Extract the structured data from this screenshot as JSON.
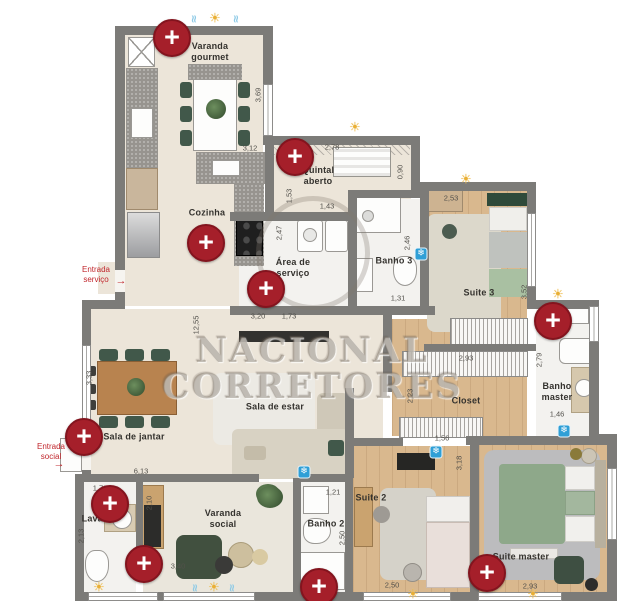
{
  "watermark": {
    "line1": "NACIONAL",
    "line2": "CORRETORES"
  },
  "glyphs": {
    "marker": "+",
    "sun": "☀",
    "snowflake": "❄",
    "water": "≈",
    "arrow": "→"
  },
  "colors": {
    "marker_red": "#a51f2a",
    "entrance_red": "#c1272d",
    "sun_yellow": "#e9af35",
    "snowflake_blue": "#2f9fd6",
    "wall_gray": "#7c7b78",
    "wood_floor": "#d9b88e"
  },
  "rooms": [
    {
      "id": "varanda-gourmet",
      "label": "Varanda\ngourmet",
      "x": 210,
      "y": 52
    },
    {
      "id": "quintal-aberto",
      "label": "Quintal\naberto",
      "x": 318,
      "y": 176
    },
    {
      "id": "cozinha",
      "label": "Cozinha",
      "x": 207,
      "y": 213
    },
    {
      "id": "area-de-servico",
      "label": "Área de\nserviço",
      "x": 293,
      "y": 268
    },
    {
      "id": "banho-3",
      "label": "Banho 3",
      "x": 394,
      "y": 261
    },
    {
      "id": "suite-3",
      "label": "Suite 3",
      "x": 479,
      "y": 293
    },
    {
      "id": "banho-master",
      "label": "Banho\nmaster",
      "x": 557,
      "y": 392
    },
    {
      "id": "closet",
      "label": "Closet",
      "x": 466,
      "y": 401
    },
    {
      "id": "sala-de-estar",
      "label": "Sala de estar",
      "x": 275,
      "y": 407
    },
    {
      "id": "sala-de-jantar",
      "label": "Sala de jantar",
      "x": 134,
      "y": 437
    },
    {
      "id": "lavabo",
      "label": "Lavabo",
      "x": 98,
      "y": 519
    },
    {
      "id": "varanda-social",
      "label": "Varanda\nsocial",
      "x": 223,
      "y": 519
    },
    {
      "id": "banho-2",
      "label": "Banho 2",
      "x": 326,
      "y": 524
    },
    {
      "id": "suite-2",
      "label": "Suite 2",
      "x": 371,
      "y": 498
    },
    {
      "id": "suite-master",
      "label": "Suite master",
      "x": 521,
      "y": 557
    }
  ],
  "entrances": [
    {
      "id": "entrada-servico",
      "label": "Entrada\nserviço",
      "x": 96,
      "y": 275,
      "ax": 121,
      "ay": 281
    },
    {
      "id": "entrada-social",
      "label": "Entrada\nsocial",
      "x": 51,
      "y": 452,
      "ax": 59,
      "ay": 464
    }
  ],
  "dimensions": [
    {
      "t": "3,69",
      "x": 258,
      "y": 95,
      "v": 1
    },
    {
      "t": "3,12",
      "x": 250,
      "y": 148,
      "v": 0
    },
    {
      "t": "2,78",
      "x": 332,
      "y": 147,
      "v": 0
    },
    {
      "t": "0,90",
      "x": 400,
      "y": 172,
      "v": 1
    },
    {
      "t": "1,53",
      "x": 289,
      "y": 196,
      "v": 1
    },
    {
      "t": "1,43",
      "x": 327,
      "y": 206,
      "v": 0
    },
    {
      "t": "2,53",
      "x": 451,
      "y": 198,
      "v": 0
    },
    {
      "t": "3,52",
      "x": 524,
      "y": 292,
      "v": 1
    },
    {
      "t": "2,46",
      "x": 407,
      "y": 243,
      "v": 1
    },
    {
      "t": "1,31",
      "x": 398,
      "y": 298,
      "v": 0
    },
    {
      "t": "2,47",
      "x": 279,
      "y": 233,
      "v": 1
    },
    {
      "t": "3,20",
      "x": 258,
      "y": 316,
      "v": 0
    },
    {
      "t": "1,73",
      "x": 289,
      "y": 316,
      "v": 0
    },
    {
      "t": "12,55",
      "x": 196,
      "y": 325,
      "v": 1
    },
    {
      "t": "3,33",
      "x": 89,
      "y": 378,
      "v": 1
    },
    {
      "t": "2,93",
      "x": 466,
      "y": 358,
      "v": 0
    },
    {
      "t": "2,23",
      "x": 410,
      "y": 396,
      "v": 1
    },
    {
      "t": "2,79",
      "x": 539,
      "y": 360,
      "v": 1
    },
    {
      "t": "1,46",
      "x": 557,
      "y": 414,
      "v": 0
    },
    {
      "t": "1,56",
      "x": 442,
      "y": 438,
      "v": 0
    },
    {
      "t": "6,13",
      "x": 141,
      "y": 471,
      "v": 0
    },
    {
      "t": "1,78",
      "x": 100,
      "y": 488,
      "v": 0
    },
    {
      "t": "2,13",
      "x": 81,
      "y": 536,
      "v": 1
    },
    {
      "t": "2,10",
      "x": 149,
      "y": 503,
      "v": 1
    },
    {
      "t": "3,40",
      "x": 178,
      "y": 566,
      "v": 0
    },
    {
      "t": "1,21",
      "x": 333,
      "y": 492,
      "v": 0
    },
    {
      "t": "2,50",
      "x": 342,
      "y": 538,
      "v": 1
    },
    {
      "t": "3,18",
      "x": 459,
      "y": 463,
      "v": 1
    },
    {
      "t": "2,50",
      "x": 392,
      "y": 585,
      "v": 0
    },
    {
      "t": "2,93",
      "x": 530,
      "y": 586,
      "v": 0
    }
  ],
  "markers": [
    {
      "room": "varanda-gourmet",
      "x": 172,
      "y": 38
    },
    {
      "room": "quintal-aberto",
      "x": 295,
      "y": 157
    },
    {
      "room": "cozinha",
      "x": 206,
      "y": 243
    },
    {
      "room": "area-de-servico",
      "x": 266,
      "y": 289
    },
    {
      "room": "banho-master",
      "x": 553,
      "y": 321
    },
    {
      "room": "sala-de-jantar",
      "x": 84,
      "y": 437
    },
    {
      "room": "lavabo",
      "x": 110,
      "y": 504
    },
    {
      "room": "varanda-social",
      "x": 144,
      "y": 564
    },
    {
      "room": "banho-2",
      "x": 319,
      "y": 587
    },
    {
      "room": "suite-master",
      "x": 487,
      "y": 573
    }
  ],
  "icons": {
    "suns": [
      {
        "x": 215,
        "y": 19
      },
      {
        "x": 355,
        "y": 128
      },
      {
        "x": 466,
        "y": 180
      },
      {
        "x": 558,
        "y": 295
      },
      {
        "x": 99,
        "y": 588
      },
      {
        "x": 214,
        "y": 588
      },
      {
        "x": 413,
        "y": 595
      },
      {
        "x": 533,
        "y": 595
      }
    ],
    "waters": [
      {
        "x": 194,
        "y": 19
      },
      {
        "x": 236,
        "y": 19
      },
      {
        "x": 195,
        "y": 588
      },
      {
        "x": 232,
        "y": 588
      }
    ],
    "snowflakes": [
      {
        "x": 421,
        "y": 254
      },
      {
        "x": 304,
        "y": 472
      },
      {
        "x": 436,
        "y": 452
      },
      {
        "x": 564,
        "y": 431
      }
    ]
  }
}
